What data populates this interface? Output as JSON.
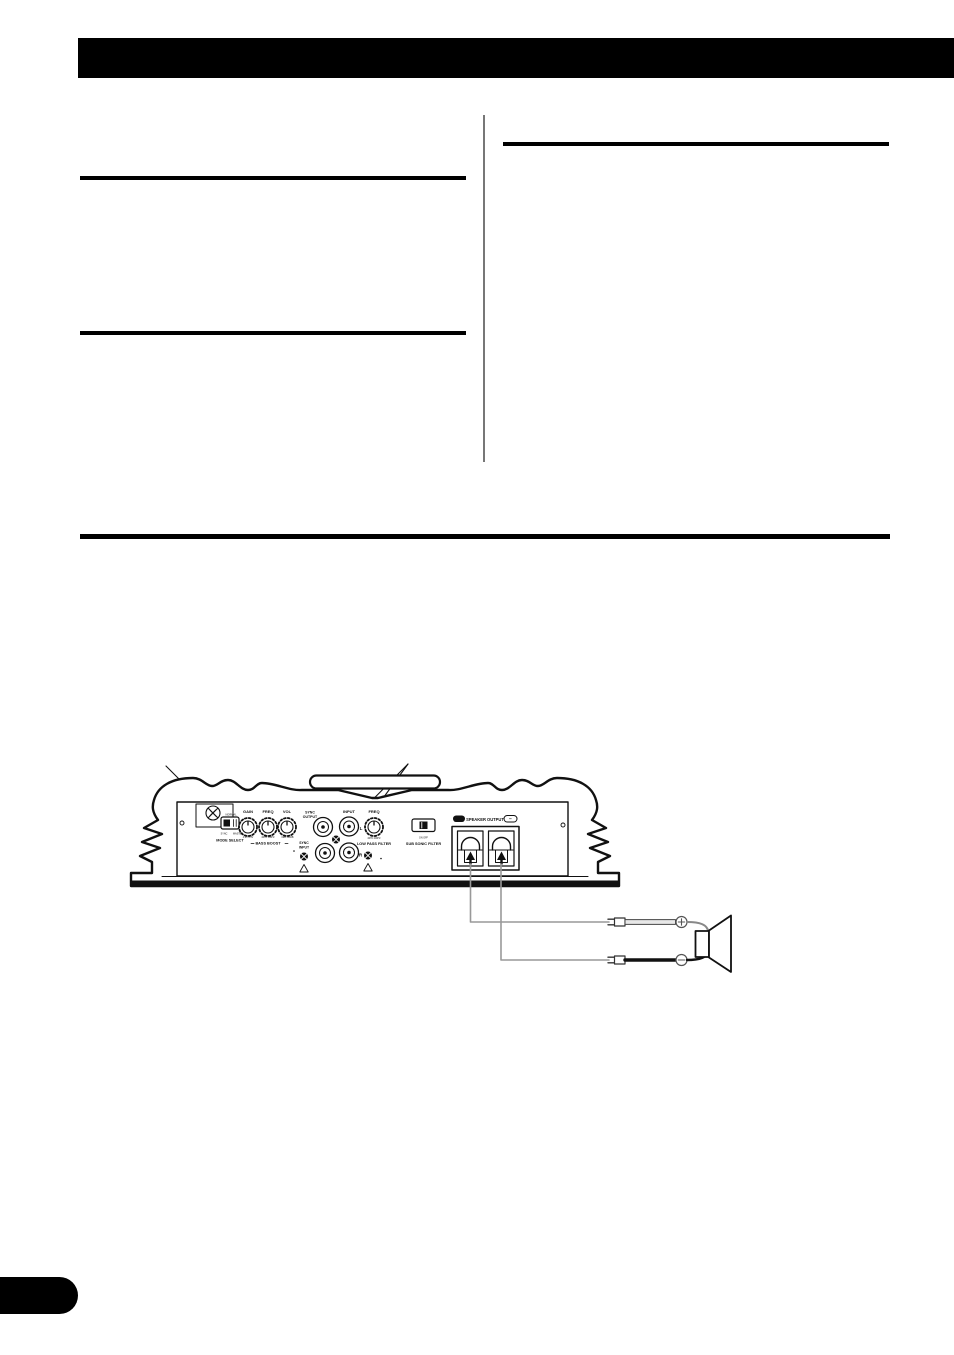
{
  "document": {
    "kind": "amplifier owner's manual page",
    "accent_color": "#000000"
  },
  "diagram": {
    "mode_select": {
      "top_mark": "NORMAL",
      "mark_left": "SYNC",
      "mark_right": "MASTER",
      "label": "MODE SELECT"
    },
    "knobs": {
      "gain": "GAIN",
      "freq": "FREQ",
      "vol": "VOL",
      "gain_marks": "4.2V 0.3V",
      "freq_marks": "40Hz 100Hz",
      "vol_marks": "0dB +12dB",
      "bass_boost": "BASS BOOST"
    },
    "sync_output": {
      "line1": "SYNC",
      "line2": "OUTPUT"
    },
    "sync_input": {
      "line1": "SYNC",
      "line2": "INPUT"
    },
    "input": {
      "label": "INPUT",
      "left": "L",
      "right": "R"
    },
    "low_pass": {
      "label": "FREQ",
      "marks": "40Hz 200Hz",
      "filter": "LOW PASS FILTER"
    },
    "subsonic": {
      "marks": "ON OFF",
      "label": "SUB SONIC FILTER"
    },
    "speaker_output": {
      "plus": "+",
      "label": "SPEAKER OUTPUT",
      "minus": "−"
    },
    "speaker_leads": {
      "positive": "+",
      "negative": "−"
    }
  }
}
